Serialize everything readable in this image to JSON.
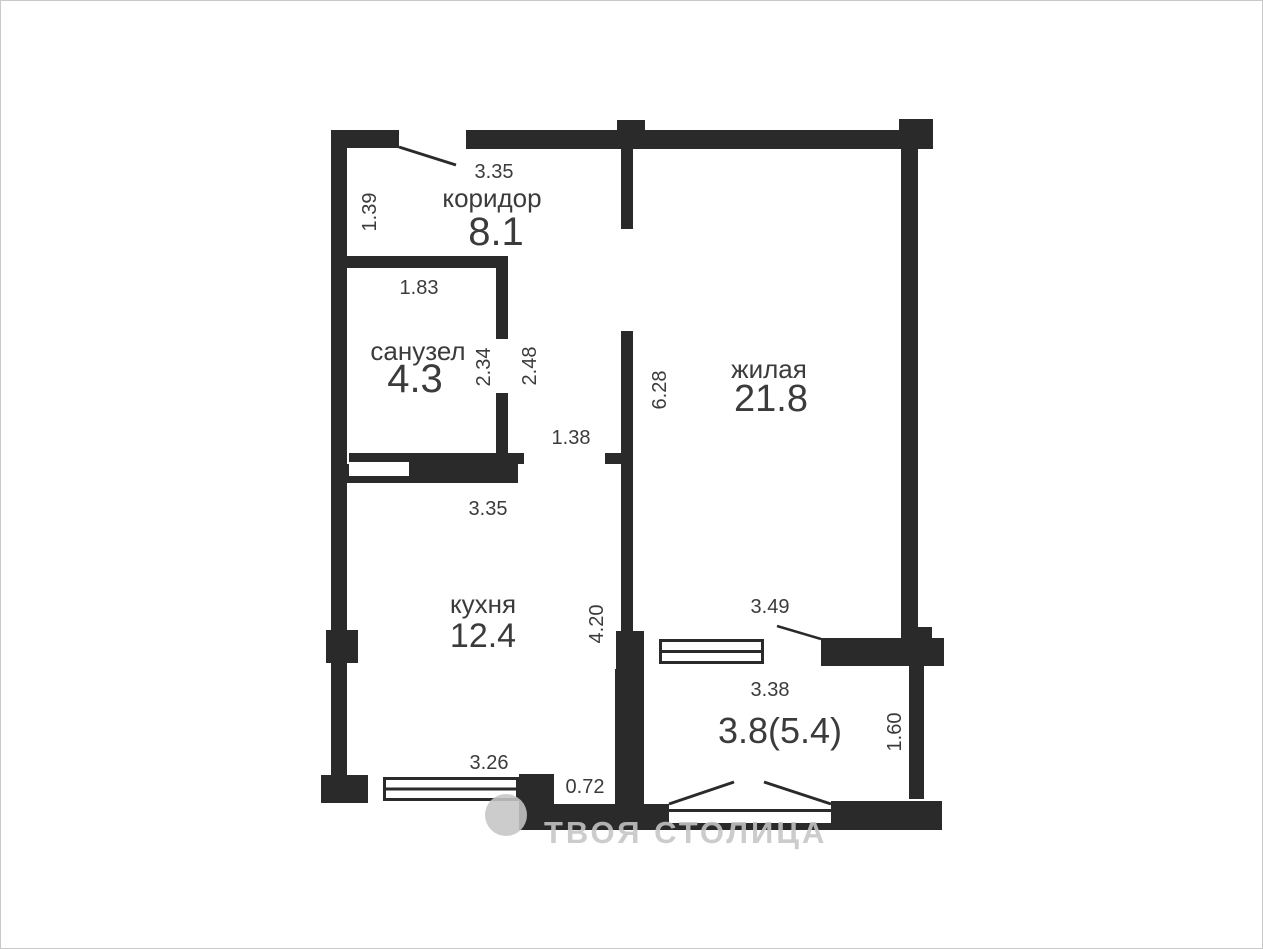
{
  "plan": {
    "type": "apartment-floor-plan",
    "rooms": [
      {
        "name": "коридор",
        "area": "8.1"
      },
      {
        "name": "санузел",
        "area": "4.3"
      },
      {
        "name": "жилая",
        "area": "21.8"
      },
      {
        "name": "кухня",
        "area": "12.4"
      },
      {
        "area": "3.8(5.4)"
      }
    ],
    "dimensions": [
      {
        "value": "3.35",
        "orientation": "horizontal"
      },
      {
        "value": "1.39",
        "orientation": "vertical"
      },
      {
        "value": "1.83",
        "orientation": "horizontal"
      },
      {
        "value": "2.34",
        "orientation": "vertical"
      },
      {
        "value": "2.48",
        "orientation": "vertical"
      },
      {
        "value": "1.38",
        "orientation": "horizontal"
      },
      {
        "value": "6.28",
        "orientation": "vertical"
      },
      {
        "value": "3.35",
        "orientation": "horizontal"
      },
      {
        "value": "4.20",
        "orientation": "vertical"
      },
      {
        "value": "3.49",
        "orientation": "horizontal"
      },
      {
        "value": "3.38",
        "orientation": "horizontal"
      },
      {
        "value": "1.60",
        "orientation": "vertical"
      },
      {
        "value": "3.26",
        "orientation": "horizontal"
      },
      {
        "value": "0.72",
        "orientation": "horizontal"
      }
    ],
    "watermark": {
      "text": "ТВОЯ СТОЛИЦА",
      "logo": "circle-mark"
    },
    "colors": {
      "wall": "#2a2a2a",
      "text": "#3b3b3b",
      "watermark": "rgba(197,197,197,0.88)",
      "background": "#ffffff",
      "border": "#c9c9c9"
    }
  }
}
